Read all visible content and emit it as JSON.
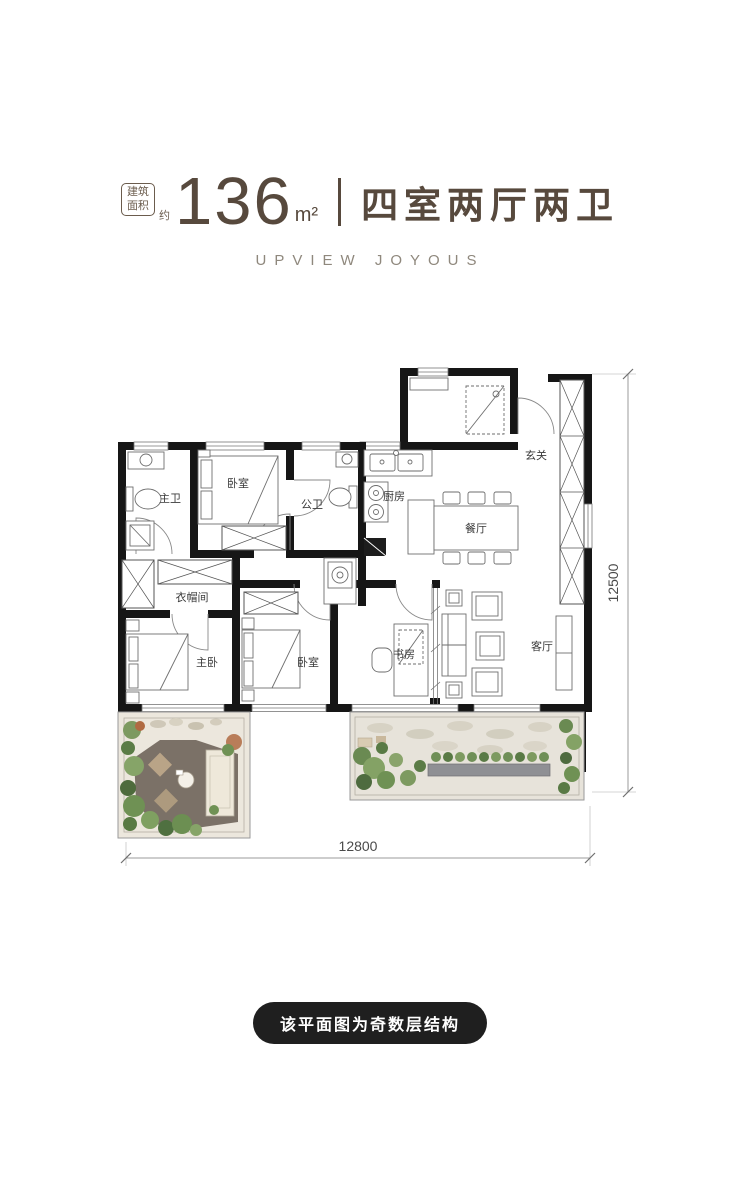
{
  "header": {
    "area_tag": {
      "line1": "建筑",
      "line2": "面积"
    },
    "approx_label": "约",
    "area_value": "136",
    "area_unit": "m²",
    "title": "四室两厅两卫",
    "subtitle": "UPVIEW JOYOUS",
    "accent_color": "#57493d"
  },
  "plan": {
    "rooms": [
      {
        "id": "master-bath",
        "label": "主卫"
      },
      {
        "id": "bedroom-top",
        "label": "卧室"
      },
      {
        "id": "public-bath",
        "label": "公卫"
      },
      {
        "id": "kitchen",
        "label": "厨房"
      },
      {
        "id": "foyer",
        "label": "玄关"
      },
      {
        "id": "dining",
        "label": "餐厅"
      },
      {
        "id": "cloakroom",
        "label": "衣帽间"
      },
      {
        "id": "master-bedroom",
        "label": "主卧"
      },
      {
        "id": "bedroom-2",
        "label": "卧室"
      },
      {
        "id": "study",
        "label": "书房"
      },
      {
        "id": "living",
        "label": "客厅"
      }
    ],
    "dimensions": {
      "bottom_width": "12800",
      "right_height": "12500"
    },
    "wall_color": "#161616"
  },
  "footer": {
    "note": "该平面图为奇数层结构",
    "bg": "#1f1f1f",
    "text_color": "#ffffff"
  }
}
